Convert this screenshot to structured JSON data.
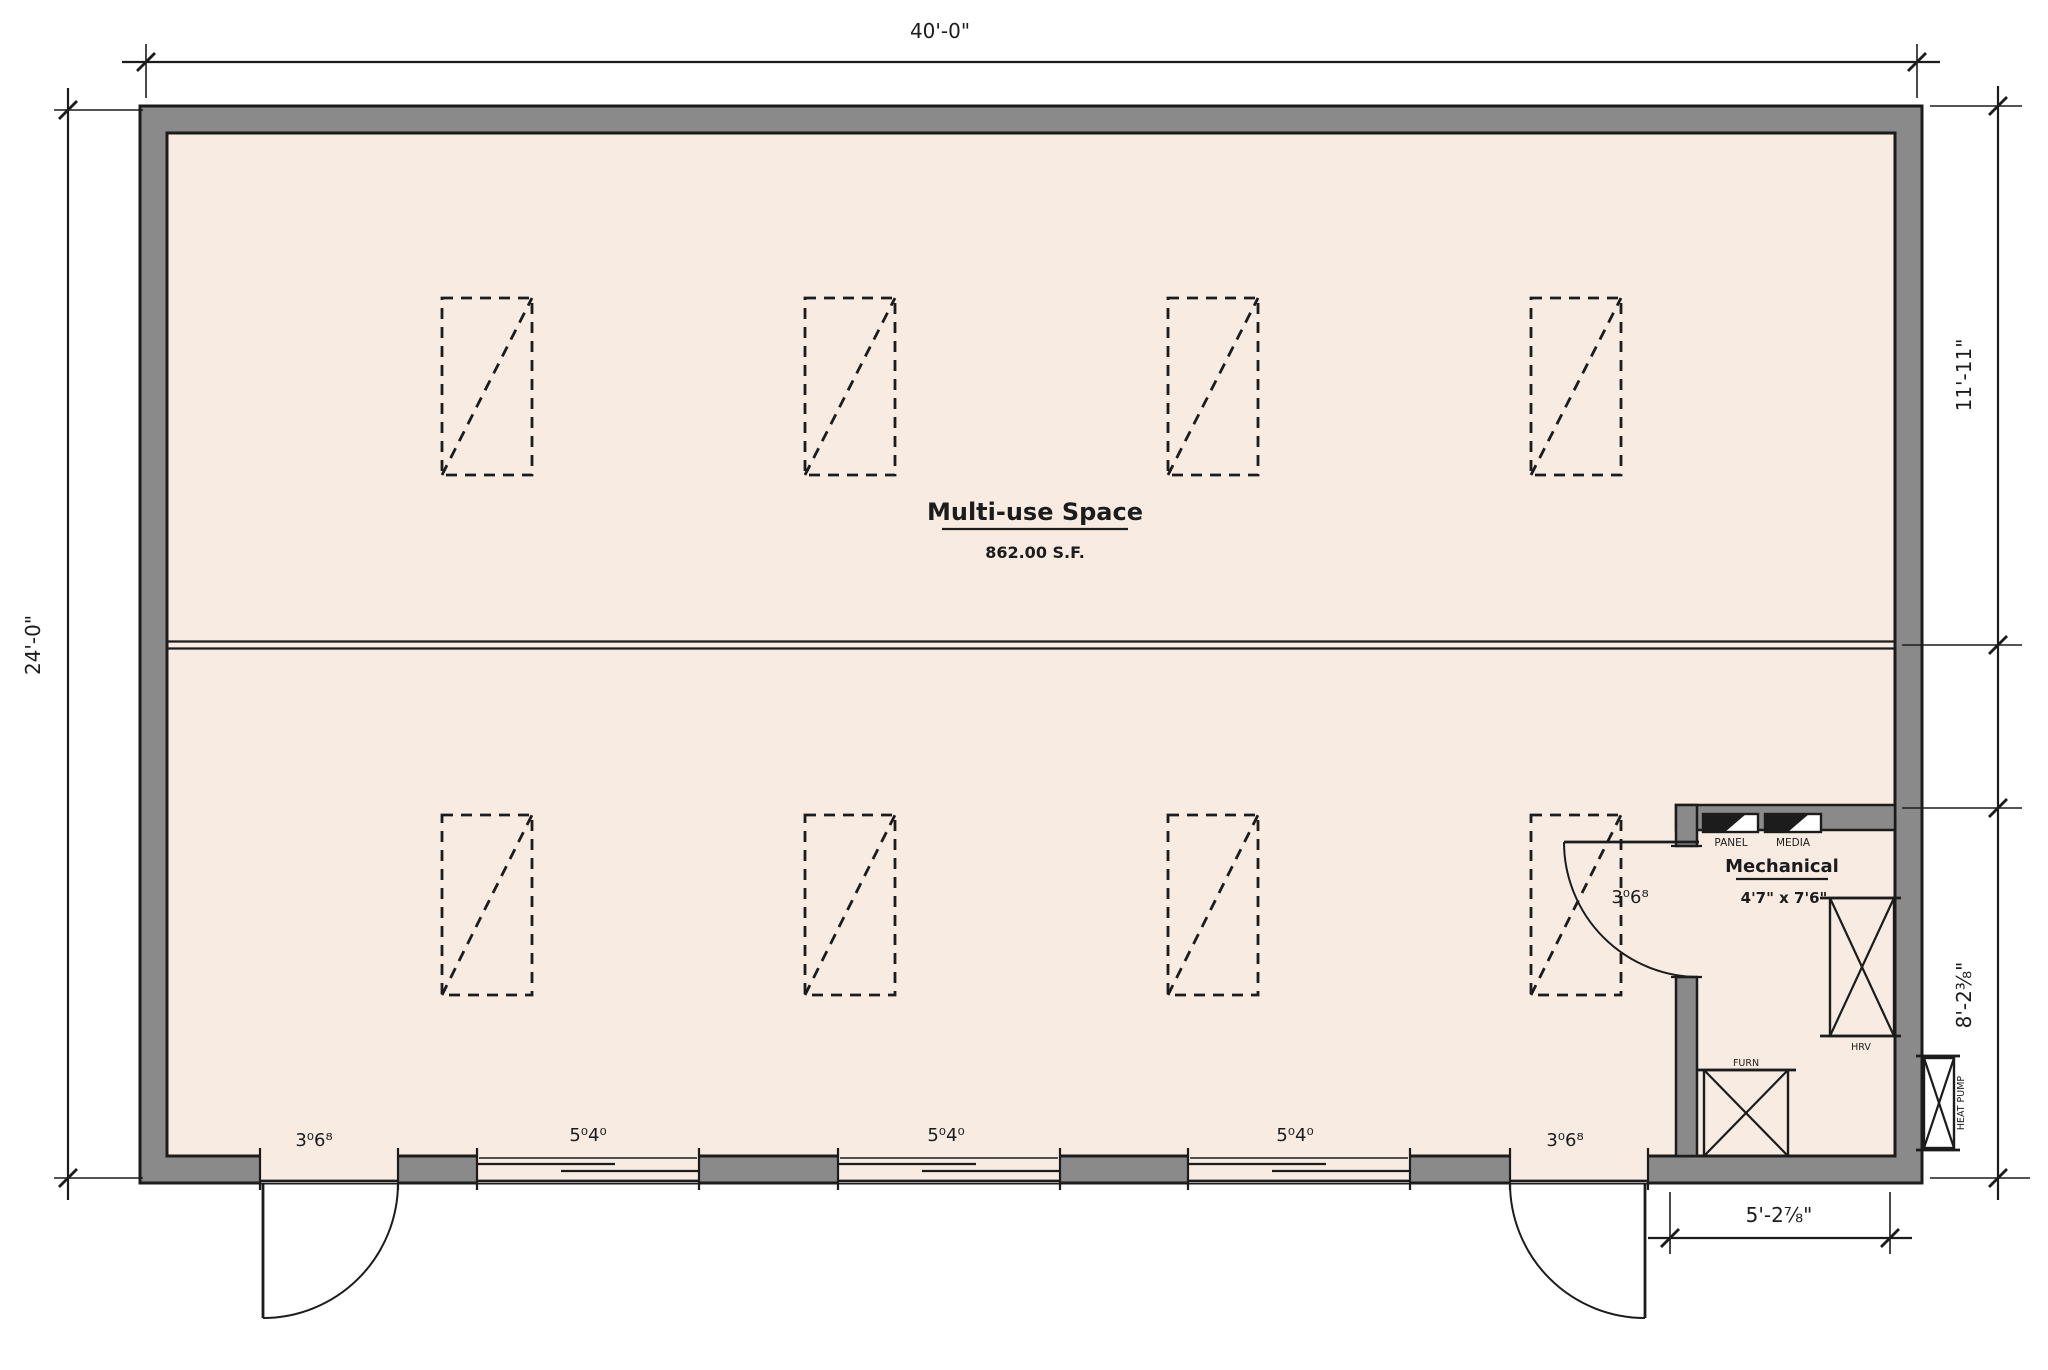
{
  "plan": {
    "room": {
      "name": "Multi-use Space",
      "area": "862.00 S.F."
    },
    "mechanical_room": {
      "name": "Mechanical",
      "size": "4'7\" x 7'6\"",
      "equipment": [
        {
          "id": "panel",
          "label": "PANEL"
        },
        {
          "id": "media",
          "label": "MEDIA"
        },
        {
          "id": "hrv",
          "label": "HRV"
        },
        {
          "id": "furnace",
          "label": "FURN"
        },
        {
          "id": "heat_pump",
          "label": "HEAT PUMP"
        }
      ]
    },
    "dimensions": {
      "overall_width": "40'-0\"",
      "overall_depth": "24'-0\"",
      "upper_depth": "11'-11\"",
      "lower_depth": "8'-2⅜\"",
      "mech_width": "5'-2⅞\""
    },
    "openings": {
      "door_labels": [
        "3⁰6⁸",
        "3⁰6⁸",
        "3⁰6⁸"
      ],
      "window_labels": [
        "5⁰4⁰",
        "5⁰4⁰",
        "5⁰4⁰"
      ]
    },
    "colors": {
      "floor": "#f7ebe2",
      "wall": "#8a8a8a",
      "line": "#1c1c1c"
    }
  }
}
